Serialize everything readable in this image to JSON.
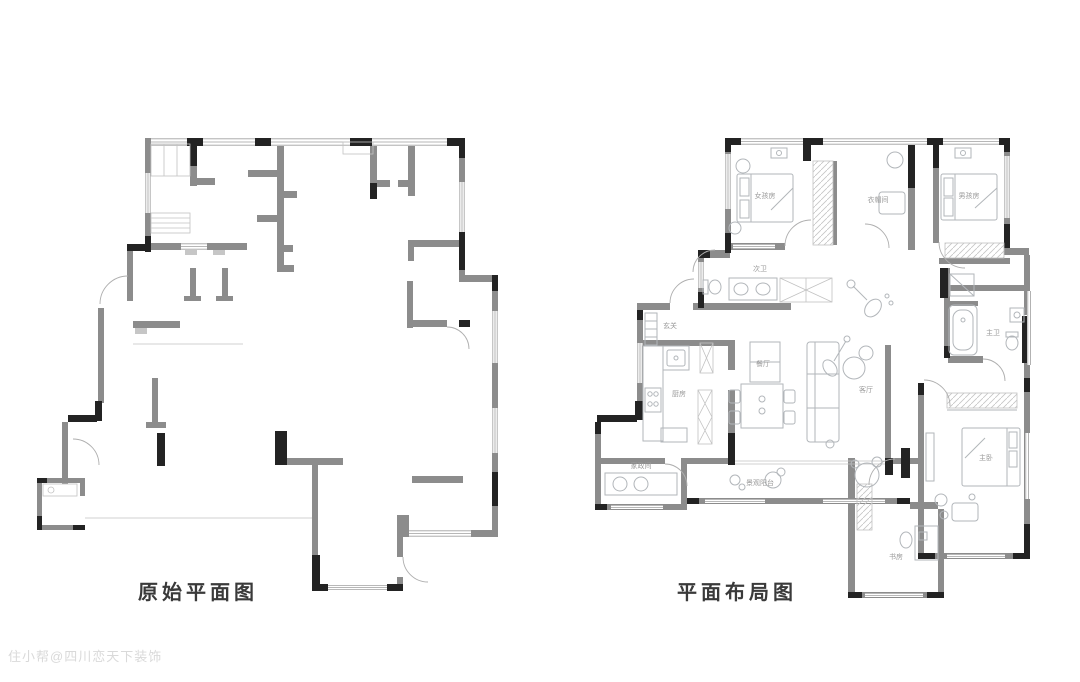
{
  "titles": {
    "left": "原始平面图",
    "right": "平面布局图"
  },
  "watermark": "住小帮@四川恋天下装饰",
  "right_plan_rooms": {
    "girl_bedroom": "女孩房",
    "cloakroom": "衣帽间",
    "boy_bedroom": "男孩房",
    "guest_bath": "次卫",
    "entry": "玄关",
    "kitchen": "厨房",
    "dining": "餐厅",
    "living": "客厅",
    "laundry": "家政间",
    "balcony": "景观阳台",
    "master_bath": "主卫",
    "master_bedroom": "主卧",
    "study": "书房"
  },
  "colors": {
    "wall_gray": "#8c8c8c",
    "structure_black": "#232323",
    "furniture_line": "#b2b6ba",
    "room_label": "#9a9a9a",
    "title_text": "#3a3a3a",
    "watermark_text": "#b9b9b9",
    "background": "#ffffff"
  }
}
